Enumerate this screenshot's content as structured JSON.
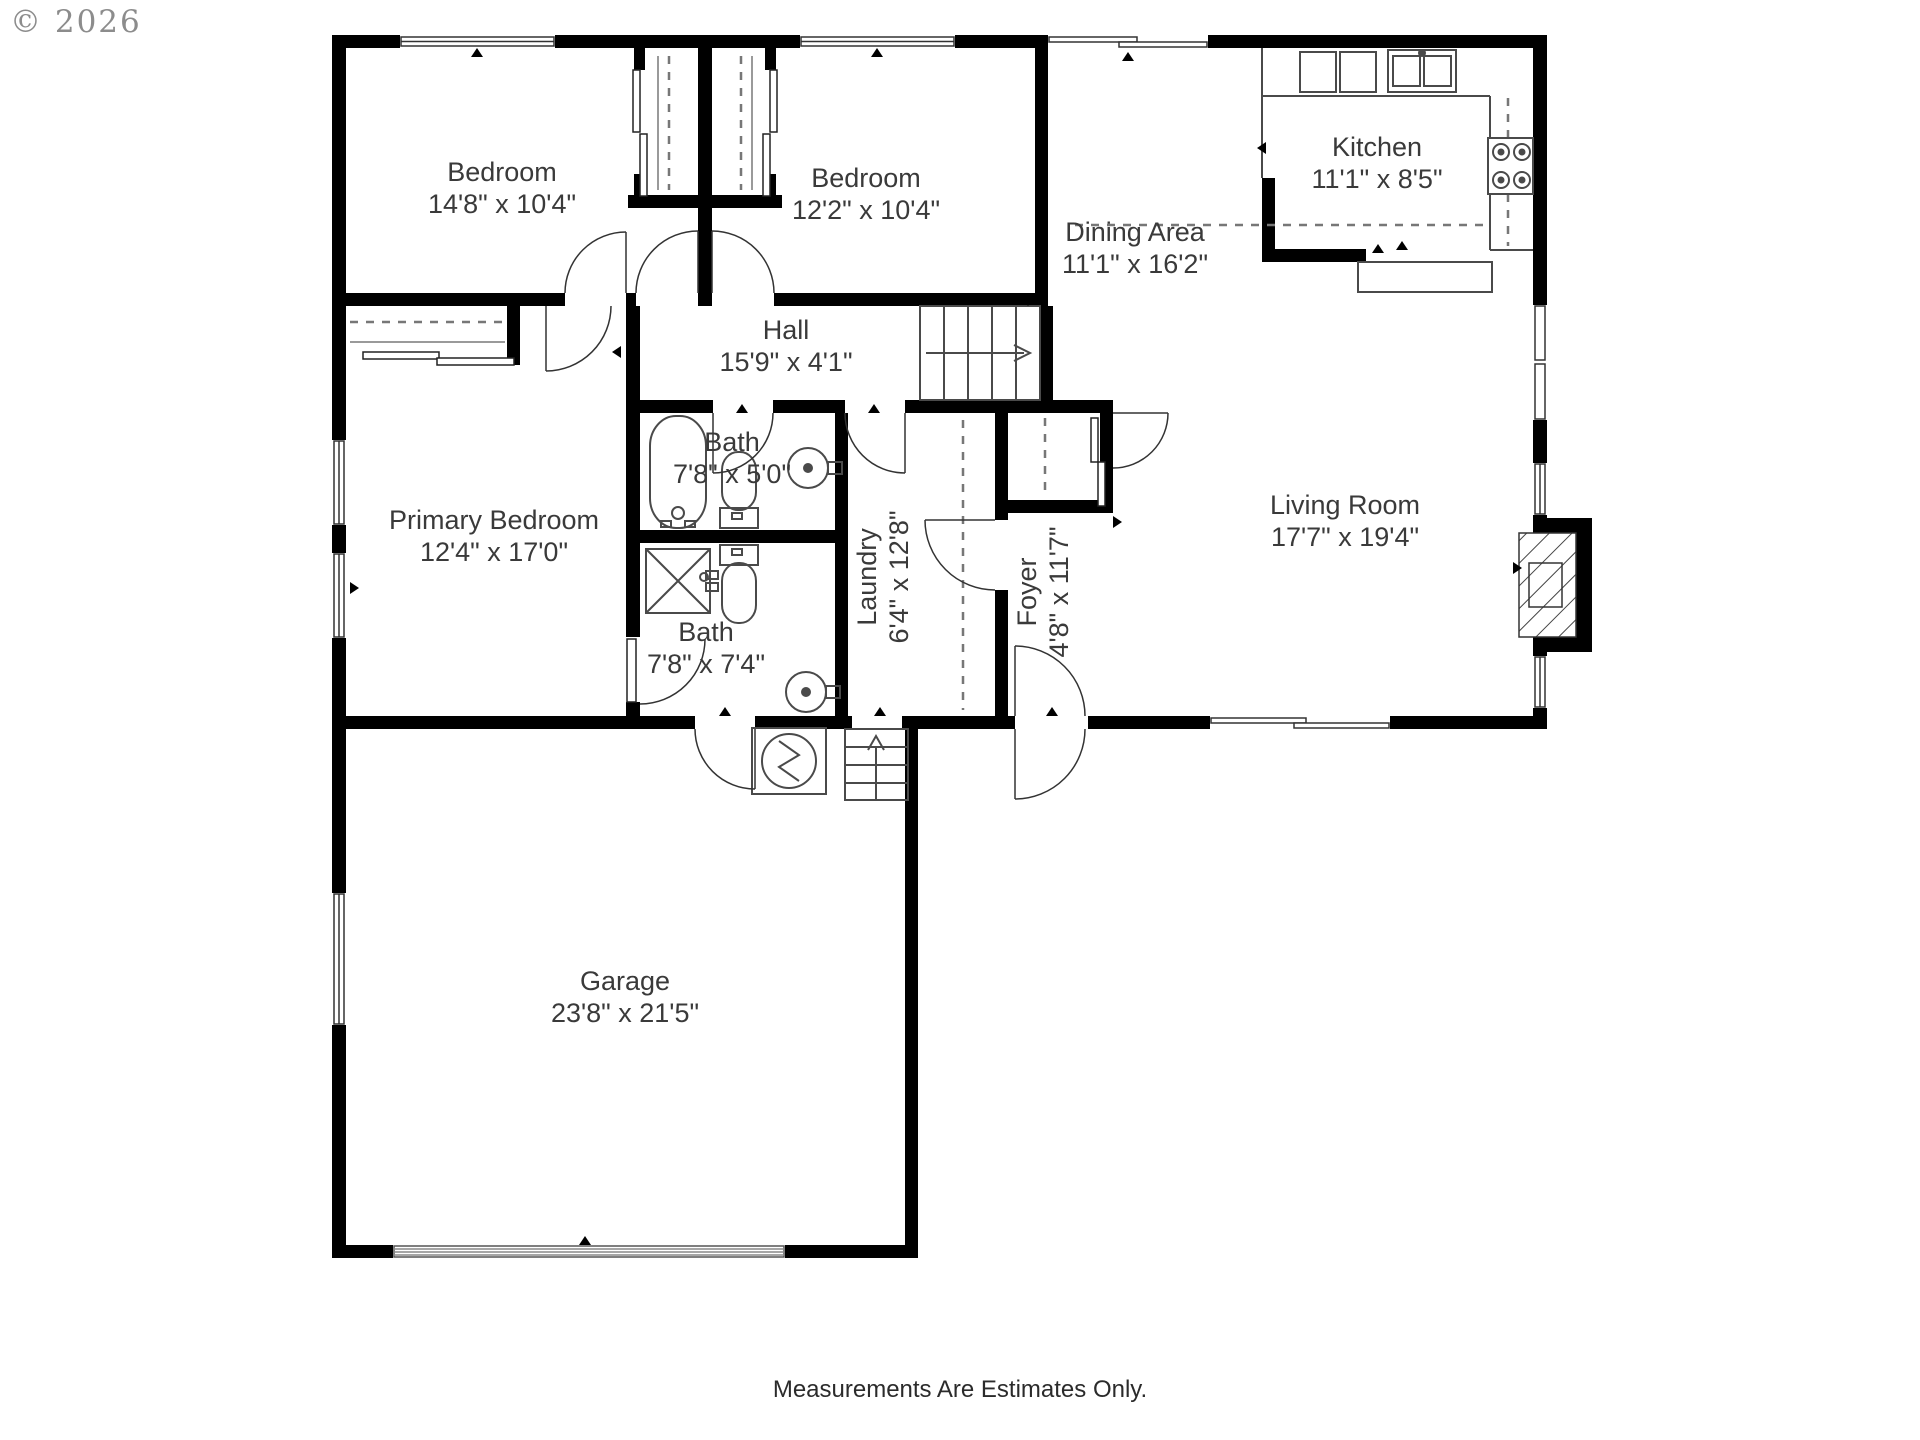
{
  "copyright": "© 2026",
  "disclaimer": "Measurements Are Estimates Only.",
  "colors": {
    "wall": "#000000",
    "line": "#3f3f3f",
    "text": "#3a3a3a",
    "copyright": "#8c8c8c"
  },
  "rooms": [
    {
      "name": "Bedroom",
      "dims": "14'8\" x 10'4\""
    },
    {
      "name": "Bedroom",
      "dims": "12'2\" x 10'4\""
    },
    {
      "name": "Kitchen",
      "dims": "11'1\" x 8'5\""
    },
    {
      "name": "Dining Area",
      "dims": "11'1\" x 16'2\""
    },
    {
      "name": "Hall",
      "dims": "15'9\" x 4'1\""
    },
    {
      "name": "Bath",
      "dims": "7'8\" x 5'0\""
    },
    {
      "name": "Primary Bedroom",
      "dims": "12'4\" x 17'0\""
    },
    {
      "name": "Laundry",
      "dims": "6'4\" x 12'8\""
    },
    {
      "name": "Foyer",
      "dims": "4'8\" x 11'7\""
    },
    {
      "name": "Living Room",
      "dims": "17'7\" x 19'4\""
    },
    {
      "name": "Bath",
      "dims": "7'8\" x 7'4\""
    },
    {
      "name": "Garage",
      "dims": "23'8\" x 21'5\""
    }
  ]
}
